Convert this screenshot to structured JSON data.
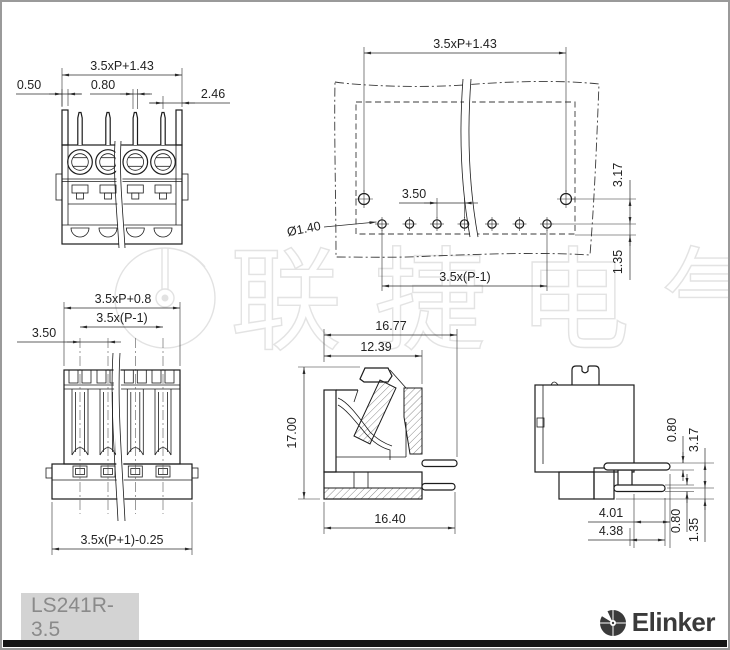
{
  "title_block": {
    "model": "LS241R-3.5",
    "brand": "Elinker"
  },
  "watermark": {
    "text": "联捷电气"
  },
  "views": {
    "front_view": {
      "dim_total_width": "3.5xP+1.43",
      "dim_wall": "0.50",
      "dim_pin_width": "0.80",
      "dim_end": "2.46"
    },
    "pcb_layout": {
      "dim_total_width": "3.5xP+1.43",
      "dim_pitch": "3.50",
      "dim_hole_dia": "Ø1.40",
      "dim_span": "3.5x(P-1)",
      "dim_row_gap": "3.17",
      "dim_edge": "1.35"
    },
    "top_view": {
      "dim_body_width": "3.5xP+0.8",
      "dim_span": "3.5x(P-1)",
      "dim_pitch": "3.50",
      "dim_flange": "3.5x(P+1)-0.25"
    },
    "section_view": {
      "dim_depth_total": "16.77",
      "dim_depth_upper": "12.39",
      "dim_height": "17.00",
      "dim_depth_lower": "16.40"
    },
    "side_view": {
      "dim_pin_thick_upper": "0.80",
      "dim_row_gap": "3.17",
      "dim_pin_len_upper": "4.01",
      "dim_pin_len_lower": "4.38",
      "dim_pin_thick_lower": "0.80",
      "dim_edge": "1.35"
    }
  }
}
